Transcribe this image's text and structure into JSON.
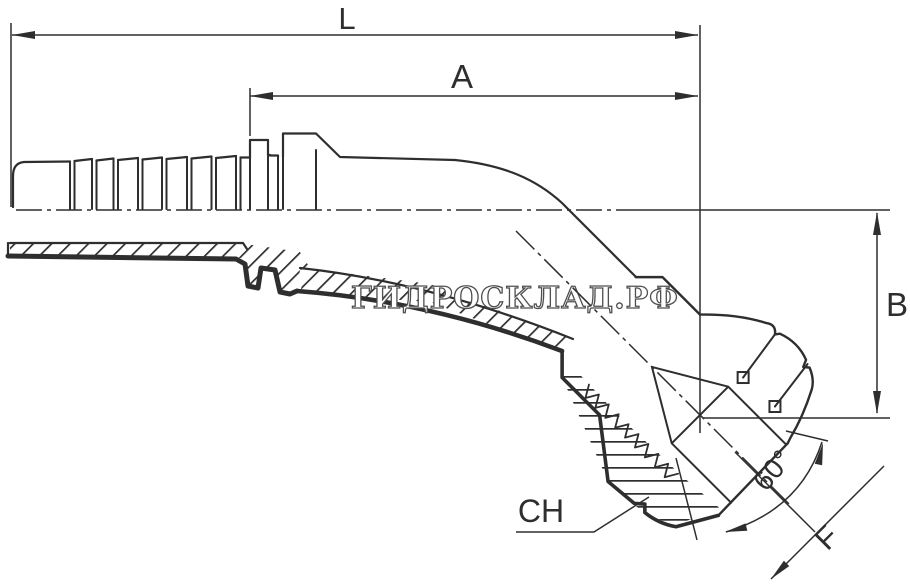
{
  "drawing": {
    "type": "technical-drawing",
    "subject": "45-degree hydraulic hose fitting with swivel nut and 60-degree cone seat, half-section view",
    "labels": {
      "length_total": "L",
      "length_a": "A",
      "height_b": "B",
      "wrench_size": "CH",
      "cone_angle": "60°",
      "thread_size": "F"
    },
    "watermark": {
      "text": "ГИДРОСКЛАД.РФ"
    },
    "colors": {
      "line": "#2e2e2e",
      "background": "#ffffff",
      "watermark_stroke": "#4f4f4f",
      "watermark_fill": "#ffffff"
    }
  }
}
